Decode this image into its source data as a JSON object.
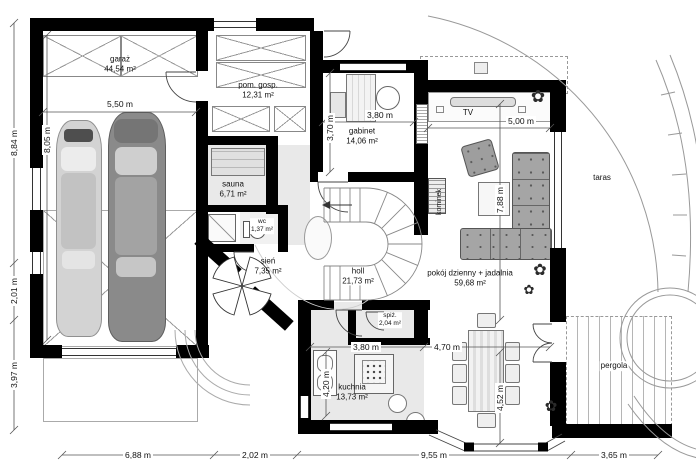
{
  "rooms": {
    "garaz": {
      "name": "garaż",
      "area": "44,54 m²"
    },
    "pom_gosp": {
      "name": "pom. gosp.",
      "area": "12,31 m²"
    },
    "sauna": {
      "name": "sauna",
      "area": "6,71 m²"
    },
    "wc": {
      "name": "wc",
      "area": "1,37 m²"
    },
    "gabinet": {
      "name": "gabinet",
      "area": "14,06 m²"
    },
    "sien": {
      "name": "sień",
      "area": "7,35 m²"
    },
    "holl": {
      "name": "holl",
      "area": "21,73 m²"
    },
    "pokoj": {
      "name": "pokój dzienny + jadalnia",
      "area": "59,68 m²"
    },
    "spiz": {
      "name": "spiż.",
      "area": "2,04 m²"
    },
    "kuchnia": {
      "name": "kuchnia",
      "area": "13,73 m²"
    }
  },
  "features": {
    "tv": "TV",
    "kominek": "kominek",
    "taras": "taras",
    "pergola": "pergola"
  },
  "dimensions": {
    "bottom": [
      "6,88 m",
      "2,02 m",
      "9,55 m",
      "3,65 m"
    ],
    "left": [
      "8,84 m",
      "2,01 m",
      "3,97 m"
    ],
    "garage_w": "5,50 m",
    "garage_d": "8,05 m",
    "gabinet_w": "3,80 m",
    "gabinet_d": "3,70 m",
    "living_w": "5,00 m",
    "living_d": "7,88 m",
    "kitchen_w": "3,80 m",
    "kitchen_d": "4,20 m",
    "dining_w": "4,70 m",
    "dining_d": "4,52 m"
  },
  "icons": {
    "plant": "✿"
  },
  "colors": {
    "wall": "#000000",
    "room_fill": "#e9e9e9",
    "furniture": "#a8a8a8",
    "line": "#777777"
  }
}
